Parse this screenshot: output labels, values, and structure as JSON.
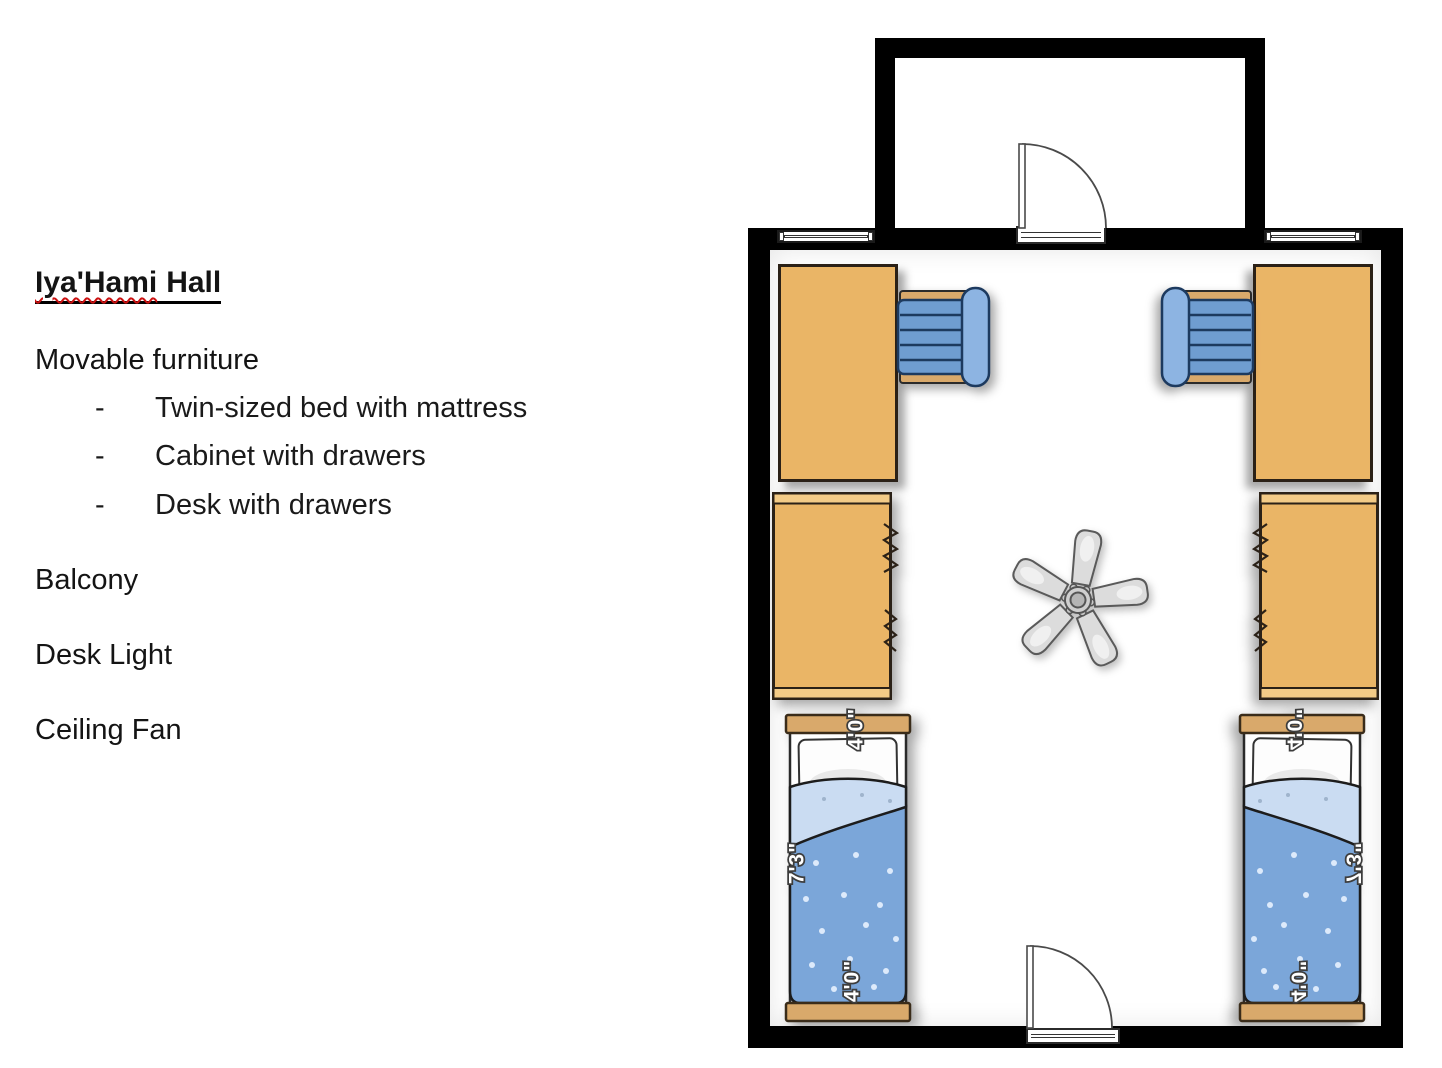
{
  "info_panel": {
    "title_word": "Iya'Hami",
    "title_rest": "Hall",
    "furniture_heading": "Movable furniture",
    "bullet": "-",
    "furniture_items": [
      "Twin-sized bed with mattress",
      "Cabinet with drawers",
      "Desk with drawers"
    ],
    "features": [
      "Balcony",
      "Desk Light",
      "Ceiling Fan"
    ]
  },
  "floor_plan": {
    "bed_labels": {
      "width_top": "4'0\"",
      "length": "7'3\"",
      "width_bottom": "4'0\""
    },
    "colors": {
      "wall": "#000000",
      "wood": "#eab566",
      "wood_trim": "#d9a96b",
      "chair_seat": "#6f9dd1",
      "chair_back": "#8db4e2",
      "blanket_blue": "#7ba6d9",
      "sheet_blue": "#cadcf2",
      "fan_blade": "#dcdcdc"
    }
  }
}
